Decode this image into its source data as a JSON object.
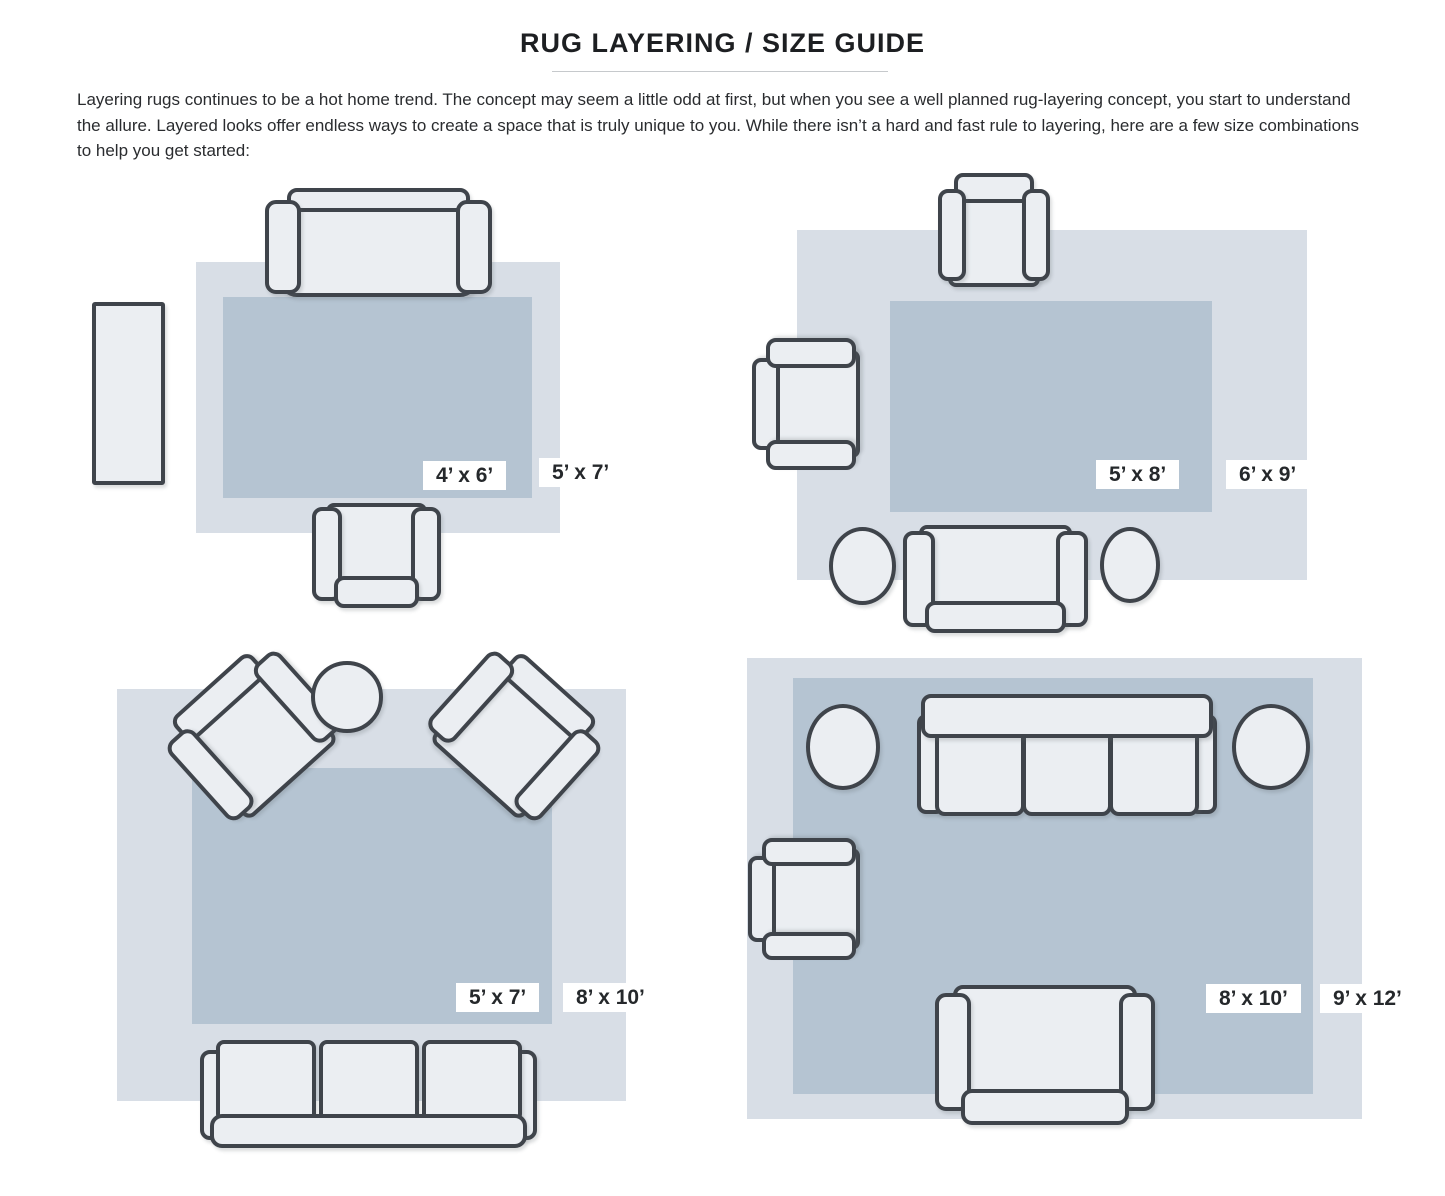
{
  "header": {
    "title": "RUG LAYERING / SIZE GUIDE"
  },
  "intro": {
    "text": "Layering rugs continues to be a hot home trend. The concept may seem a little odd at first, but when you see a well planned rug-layering concept, you start to understand the allure. Layered looks offer endless ways to create a space that is truly unique to you. While there isn’t a hard and fast rule to layering, here are a few size combinations to help you get started:"
  },
  "colors": {
    "rug_outer": "#d8dee6",
    "rug_inner": "#b5c4d2",
    "furniture_fill": "#ebeef2",
    "furniture_outline": "#3f444b",
    "label_bg": "#ffffff",
    "label_text": "#25282b",
    "title_text": "#1d1f22",
    "body_text": "#2a2c2f"
  },
  "diagrams": [
    {
      "name": "top-left",
      "layered_rug": "4’ x 6’",
      "base_rug": "5’ x 7’",
      "furniture": [
        "sofa",
        "armchair",
        "console-table"
      ]
    },
    {
      "name": "top-right",
      "layered_rug": "5’ x 8’",
      "base_rug": "6’ x 9’",
      "furniture": [
        "armchair",
        "armchair",
        "loveseat",
        "round-side-table",
        "round-side-table"
      ]
    },
    {
      "name": "bottom-left",
      "layered_rug": "5’ x 7’",
      "base_rug": "8’ x 10’",
      "furniture": [
        "armchair",
        "armchair",
        "round-side-table",
        "three-seat-sofa"
      ]
    },
    {
      "name": "bottom-right",
      "layered_rug": "8’ x 10’",
      "base_rug": "9’ x 12’",
      "furniture": [
        "three-seat-sofa",
        "armchair",
        "loveseat",
        "round-side-table",
        "round-side-table"
      ]
    }
  ]
}
